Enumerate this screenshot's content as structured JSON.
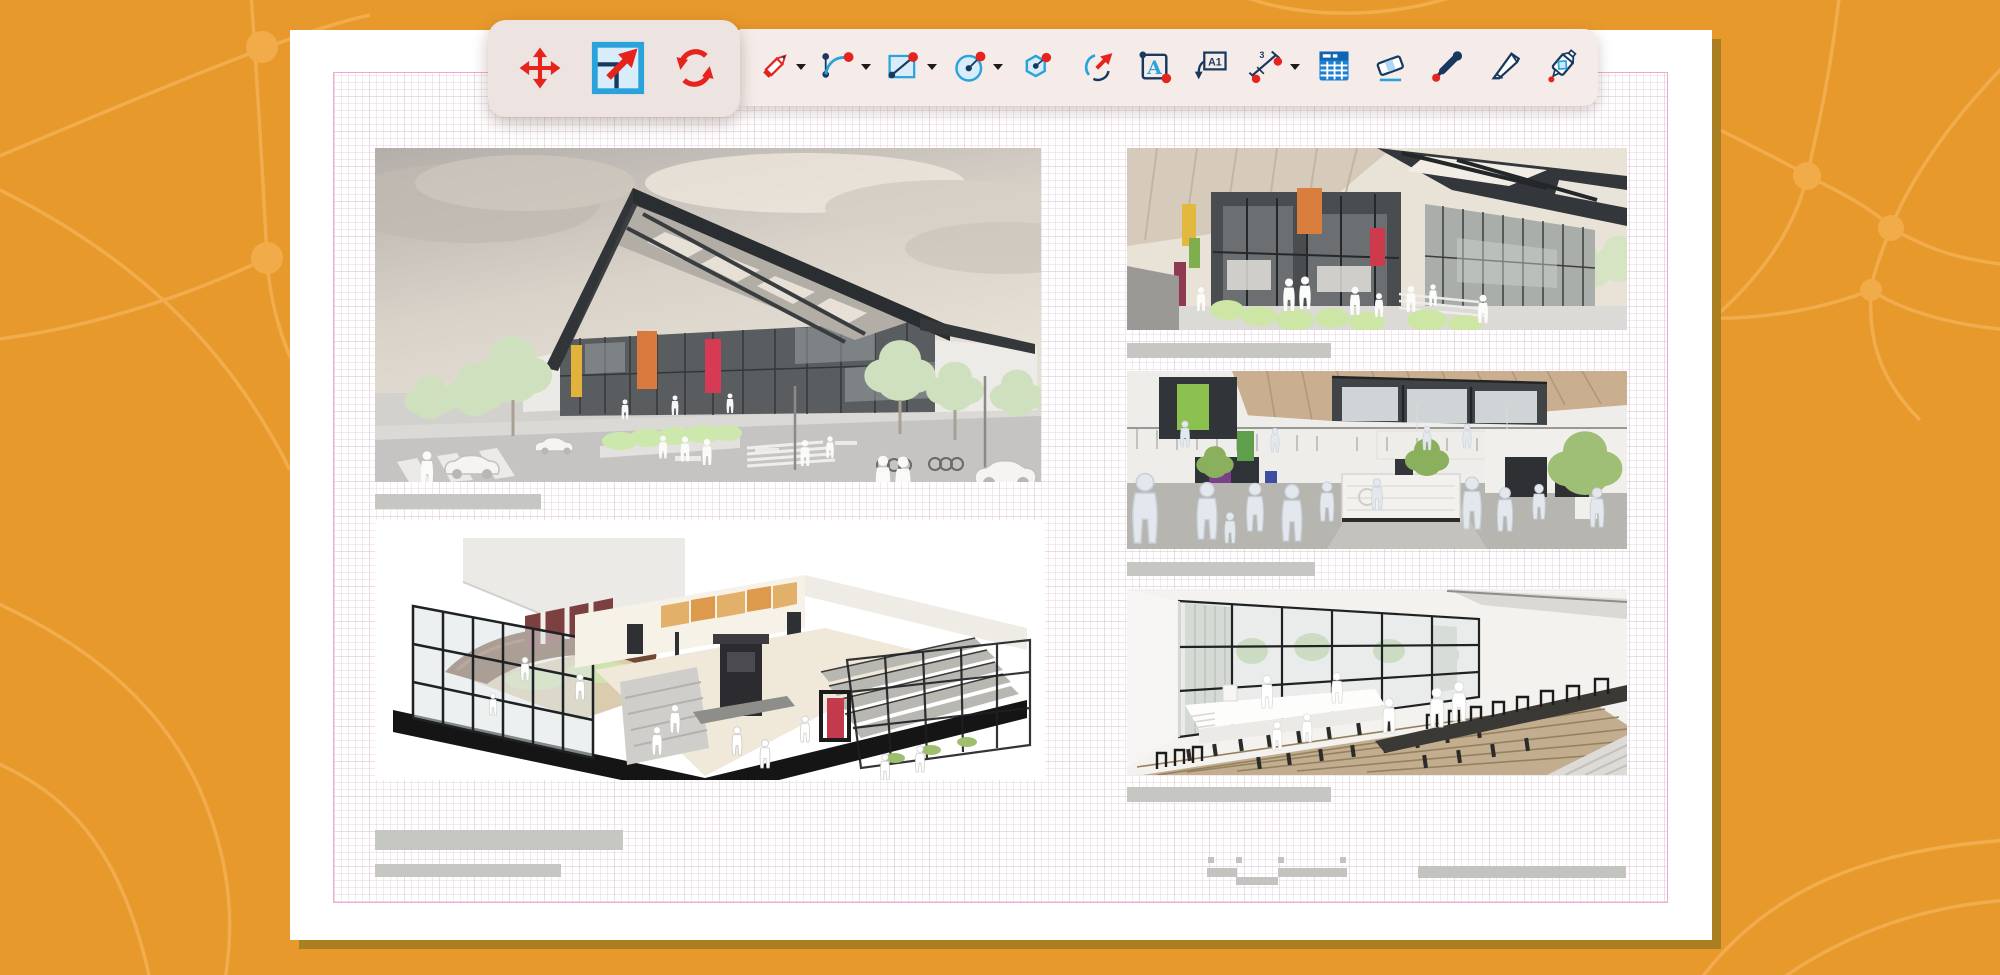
{
  "app_window": {
    "kind": "drawing-annotation-app-over-document-canvas",
    "background_color": "#E8992B",
    "background_pattern_color": "#F3B054",
    "page_color": "#FFFFFF",
    "page_shadow_color": "#AA7F22",
    "margin_guide_color": "#F0A8D4",
    "page_grid_color": "#D8BACC"
  },
  "toolbar": {
    "strip_color": "#F5ECEA",
    "raised_group_color": "#EDE4E1",
    "icon_palette": {
      "red": "#E6231D",
      "navy": "#17395F",
      "cyan": "#2AA3DC",
      "light_blue": "#D9ECF9",
      "table_blue": "#1C7FD2",
      "caret_black": "#1B1B1B"
    },
    "active_tool": "scale",
    "transform_tools": [
      {
        "name": "move",
        "active": false
      },
      {
        "name": "scale",
        "active": true
      },
      {
        "name": "rotate",
        "active": false
      }
    ],
    "drawing_tools": [
      {
        "name": "pencil-line",
        "dropdown": true
      },
      {
        "name": "arc",
        "dropdown": true
      },
      {
        "name": "rectangle",
        "dropdown": true
      },
      {
        "name": "circle",
        "dropdown": true
      },
      {
        "name": "polygon",
        "dropdown": false
      },
      {
        "name": "revision-arc",
        "dropdown": false
      },
      {
        "name": "text",
        "dropdown": false,
        "glyph": "A"
      },
      {
        "name": "text-label",
        "dropdown": false,
        "glyph": "A1"
      },
      {
        "name": "dimension",
        "dropdown": true,
        "glyph": "3"
      },
      {
        "name": "table",
        "dropdown": false
      },
      {
        "name": "eraser",
        "dropdown": false
      },
      {
        "name": "color-picker",
        "dropdown": false
      },
      {
        "name": "knife",
        "dropdown": false
      },
      {
        "name": "glue",
        "dropdown": false
      }
    ]
  },
  "document_page": {
    "description": "architecture presentation sheet with five renders and redacted gray caption bars",
    "caption_bar_color": "#C6C6C3",
    "images": [
      {
        "name": "exterior-street-render",
        "position": "top-left",
        "caption_bars": 1
      },
      {
        "name": "isometric-cutaway-render",
        "position": "bottom-left",
        "caption_bars": 2
      },
      {
        "name": "exterior-plaza-render",
        "position": "right-top",
        "caption_bars": 1
      },
      {
        "name": "atrium-interior-render",
        "position": "right-middle",
        "caption_bars": 1
      },
      {
        "name": "auditorium-render",
        "position": "right-bottom",
        "caption_bars": 1
      }
    ],
    "footer_marks": {
      "small_squares": 4,
      "small_bars": 3,
      "wide_bar": 1
    }
  }
}
